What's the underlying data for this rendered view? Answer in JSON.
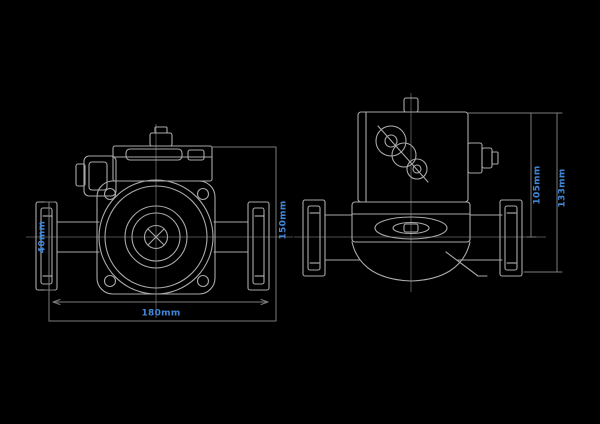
{
  "colors": {
    "bg": "#000000",
    "line": "#a9a9a9",
    "bright": "#c6c6c6",
    "dim": "#7c7c7c",
    "center": "#696969",
    "accent": "#4287d7"
  },
  "drawing": {
    "subject": "flanged-inline-circulator-pump-dimension-drawing",
    "views": [
      "front-view",
      "side-view"
    ]
  },
  "dimensions": {
    "front_flange_height": "40mm",
    "front_overall_height": "150mm",
    "front_port_to_port": "180mm",
    "side_top_to_axis": "105mm",
    "side_overall_height": "133mm"
  }
}
